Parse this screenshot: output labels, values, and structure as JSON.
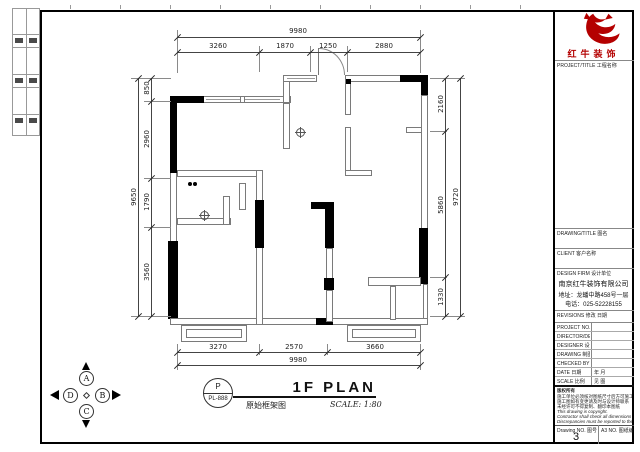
{
  "plan": {
    "title": "1F PLAN",
    "subtitle_cn": "原始框架图",
    "scale": "SCALE: 1:80",
    "tag_top": "P",
    "tag_no": "PL-888",
    "compass": {
      "n": "A",
      "e": "B",
      "s": "C",
      "w": "D"
    },
    "dims": {
      "top_overall": "9980",
      "top_segments": [
        "3260",
        "1870",
        "1250",
        "2880"
      ],
      "bottom_overall": "9980",
      "bottom_segments": [
        "3270",
        "2570",
        "3660"
      ],
      "left_overall": "9650",
      "left_segments": [
        "850",
        "2960",
        "1790",
        "3560"
      ],
      "right_overall": "9720",
      "right_segments": [
        "2160",
        "5860",
        "1330"
      ]
    }
  },
  "titleblock": {
    "brand": "红牛装饰",
    "brand_color": "#b40000",
    "sec_project": "PROJECT/TITLE 工程名称",
    "sec_drawing": "DRAWING/TITLE 图名",
    "sec_client": "CLIENT 客户名称",
    "sec_firm": "DESIGN FIRM 设计单位",
    "company_name": "南京红牛装饰有限公司",
    "company_addr": "地址：龙蟠中路458号一层",
    "company_tel": "电话：025-52228155",
    "sec_revisions": "REVISIONS 修改  日期",
    "rows": [
      {
        "label": "PROJECT NO. 项目编号",
        "value": ""
      },
      {
        "label": "DIRECTOR/DESI 设计总监",
        "value": ""
      },
      {
        "label": "DESIGNER 设计师",
        "value": ""
      },
      {
        "label": "DRAWING 制图人",
        "value": ""
      },
      {
        "label": "CHECKED BY 审核人",
        "value": ""
      },
      {
        "label": "DATE 日期",
        "value": "年  月"
      },
      {
        "label": "SCALE 比例",
        "value": "见  图"
      }
    ],
    "notes_title": "版权所有",
    "notes": [
      "施工单位必须核对图纸尺寸后方可施工",
      "施工图如有变更请及时与设计师联系",
      "未经许可不得复制、翻印本图纸",
      "This drawing is copyright.",
      "Contractor shall check all dimensions on site.",
      "Discrepancies must be reported to the designer."
    ],
    "drawing_no_label": "Drawing NO. 图号",
    "drawing_no": "3",
    "sheet_label": "A3 NO. 图纸编号"
  }
}
